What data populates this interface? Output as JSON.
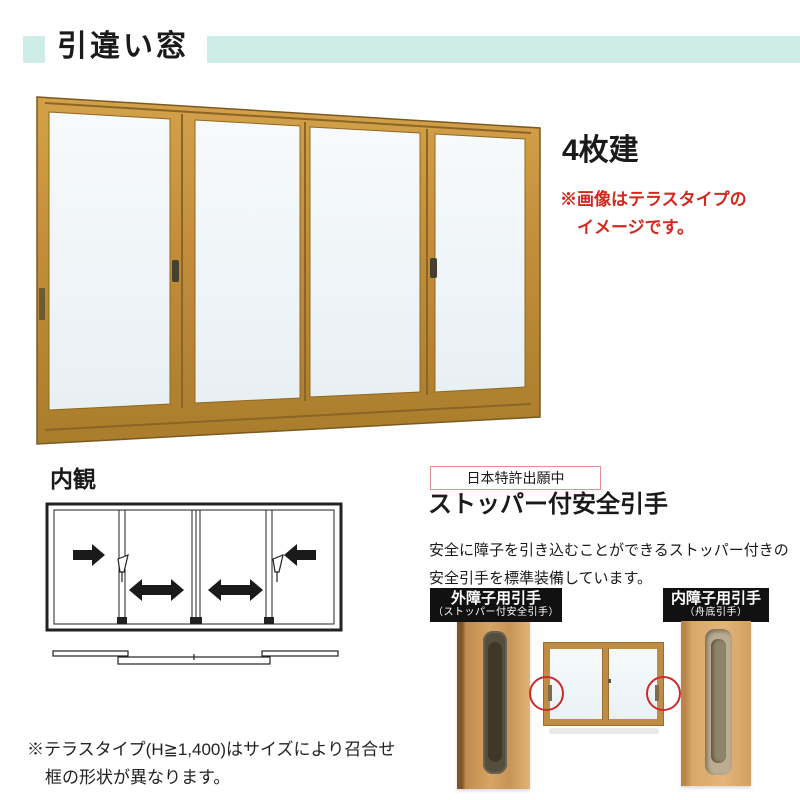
{
  "header": {
    "title": "引違い窓"
  },
  "product": {
    "type_label": "4枚建",
    "note": {
      "line1": "※画像はテラスタイプの",
      "line2": "イメージです。"
    }
  },
  "interior": {
    "label": "内観"
  },
  "feature": {
    "patent_badge": "日本特許出願中",
    "title": "ストッパー付安全引手",
    "description": {
      "line1": "安全に障子を引き込むことができるストッパー付きの",
      "line2": "安全引手を標準装備しています。"
    },
    "outer_handle": {
      "title": "外障子用引手",
      "subtitle": "（ストッパー付安全引手）"
    },
    "inner_handle": {
      "title": "内障子用引手",
      "subtitle": "（舟底引手）"
    }
  },
  "footer": {
    "note_line1": "※テラスタイプ(H≧1,400)はサイズにより召合せ",
    "note_line2": "框の形状が異なります。"
  },
  "icons": {
    "slide_right": "arrow-right-icon",
    "slide_left": "arrow-left-icon",
    "slide_both": "arrow-both-icon",
    "crescent_lock": "crescent-lock-icon"
  },
  "colors": {
    "accent_mint": "#CFEDE7",
    "note_red": "#D3281E",
    "patent_border": "#E39090",
    "label_bg": "#111111",
    "frame_gold": "#C08B3C",
    "glass": "#EFF4F7",
    "highlight_red": "#CB2B2B"
  }
}
